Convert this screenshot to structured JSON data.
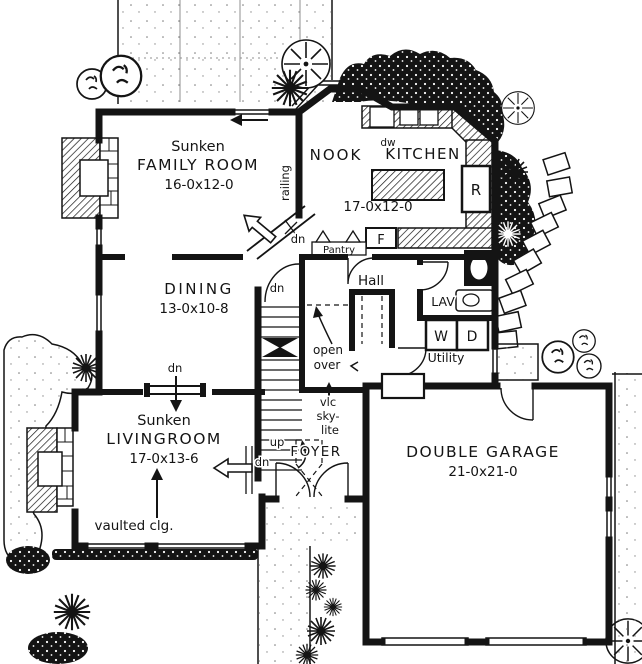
{
  "drawing": {
    "type": "house first-floor plan, hand-drafted black ink on white",
    "ink_color": "#141414",
    "paper_color": "#ffffff"
  },
  "rooms": {
    "family_room": {
      "prefix": "Sunken",
      "name": "FAMILY ROOM",
      "dims": "16-0x12-0"
    },
    "nook": {
      "name": "NOOK"
    },
    "kitchen": {
      "name": "KITCHEN",
      "dims": "17-0x12-0"
    },
    "dining": {
      "name": "DINING",
      "dims": "13-0x10-8"
    },
    "hall": {
      "name": "Hall"
    },
    "lav": {
      "name": "LAV"
    },
    "utility": {
      "name": "Utility"
    },
    "pantry": {
      "name": "Pantry"
    },
    "living_room": {
      "prefix": "Sunken",
      "name": "LIVINGROOM",
      "dims": "17-0x13-6"
    },
    "foyer": {
      "name": "FOYER"
    },
    "garage": {
      "name": "DOUBLE GARAGE",
      "dims": "21-0x21-0"
    }
  },
  "annotations": {
    "railing": "railing",
    "down": "dn",
    "up": "up",
    "open_over": [
      "open",
      "over"
    ],
    "skylight": [
      "vlc",
      "sky-",
      "lite"
    ],
    "vaulted_ceiling": "vaulted clg.",
    "dishwasher": "dw",
    "refrigerator": "R",
    "freezer": "F",
    "washer": "W",
    "dryer": "D"
  }
}
